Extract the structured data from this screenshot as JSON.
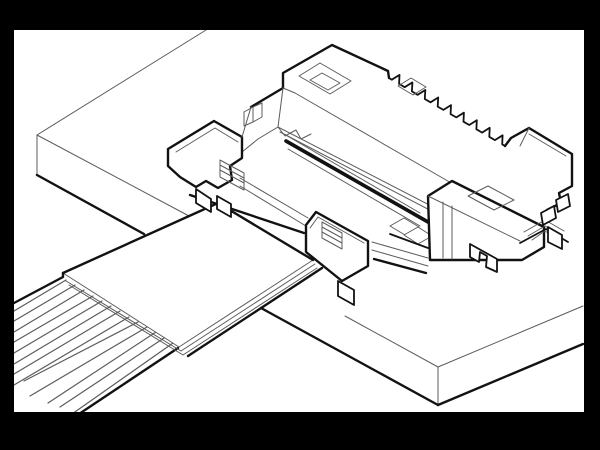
{
  "meta": {
    "title": "Isometric technical line illustration of an FPC/FFC connector mounted on a PCB with a flat flexible cable approaching from the lower left",
    "figure_type": "black-and-white engineering line drawing",
    "visible_text": []
  },
  "colors": {
    "frame": "#000000",
    "canvas": "#ffffff",
    "line-thin": "#5c5c5c",
    "line-heavy": "#121212"
  },
  "frame": {
    "left": 14,
    "top": 30,
    "right": 584,
    "bottom": 412,
    "width": 600,
    "height": 450
  },
  "components": [
    {
      "name": "pcb",
      "label": "printed circuit board slab"
    },
    {
      "name": "connector",
      "label": "FPC/FFC connector housing with latch blocks and fitting nails"
    },
    {
      "name": "contact-teeth",
      "label": "row of stamped contact terminals along rear wall"
    },
    {
      "name": "cable",
      "label": "flat flexible cable with reinforcing stiffener tab"
    }
  ],
  "cable": {
    "conductor_count": 13,
    "conductors": [
      [
        14,
        311,
        66,
        280
      ],
      [
        14,
        321,
        75,
        285
      ],
      [
        14,
        332,
        84,
        290
      ],
      [
        14,
        342,
        93,
        296
      ],
      [
        14,
        353,
        102,
        301
      ],
      [
        14,
        364,
        111,
        306
      ],
      [
        14,
        374,
        120,
        311
      ],
      [
        14,
        385,
        129,
        317
      ],
      [
        24,
        381,
        138,
        322
      ],
      [
        30,
        396,
        147,
        327
      ],
      [
        48,
        403,
        156,
        332
      ],
      [
        60,
        407,
        164,
        338
      ],
      [
        72,
        414,
        173,
        343
      ]
    ]
  },
  "connector": {
    "teeth": {
      "count": 9,
      "x0": 389,
      "y0": 78,
      "x1": 505,
      "y1": 146,
      "height": 8
    }
  }
}
